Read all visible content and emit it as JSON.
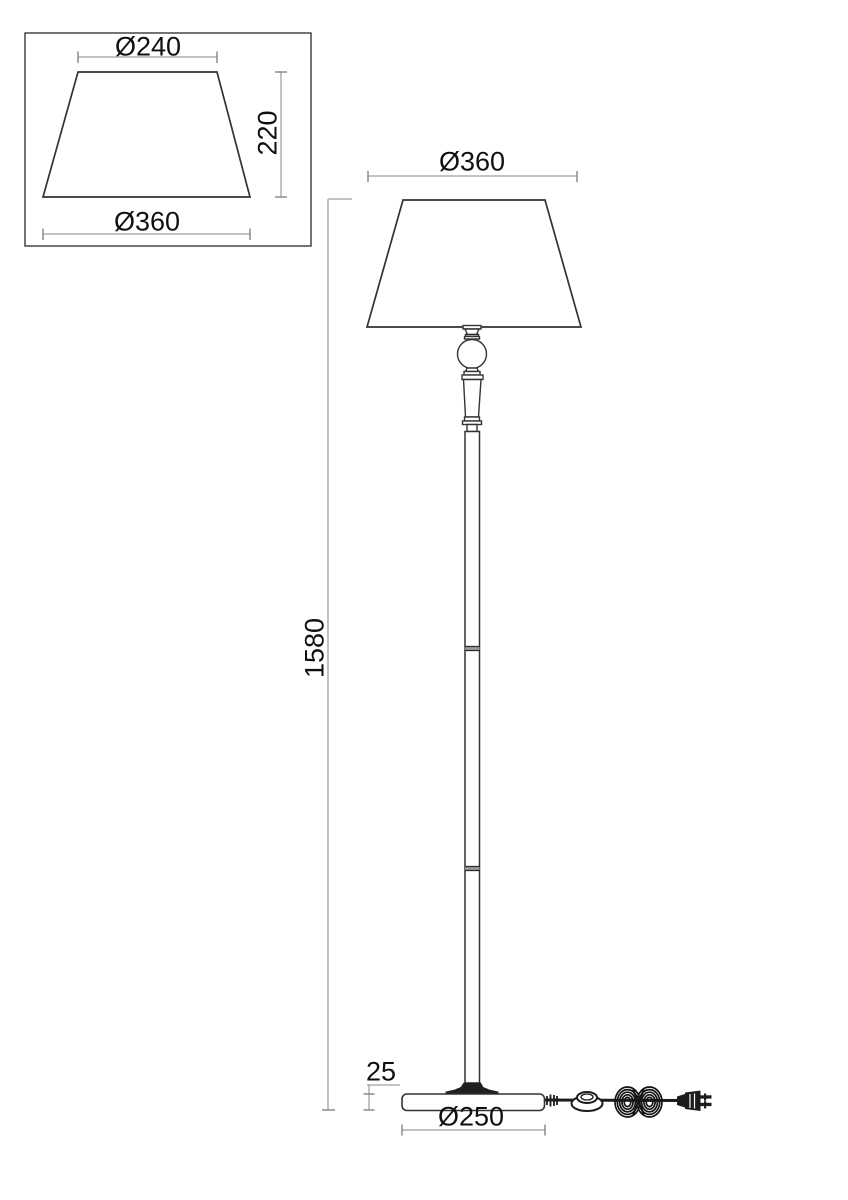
{
  "detail_view": {
    "top_diameter_label": "Ø240",
    "height_label": "220",
    "bottom_diameter_label": "Ø360"
  },
  "main_view": {
    "shade_diameter_label": "Ø360",
    "total_height_label": "1580",
    "base_height_label": "25",
    "base_diameter_label": "Ø250"
  },
  "colors": {
    "drawing_line": "#3a3a3a",
    "dimension_line": "#a0a0a0",
    "tick": "#8a8a8a",
    "text": "#101010",
    "cord": "#1d1d1d",
    "background": "#ffffff"
  }
}
